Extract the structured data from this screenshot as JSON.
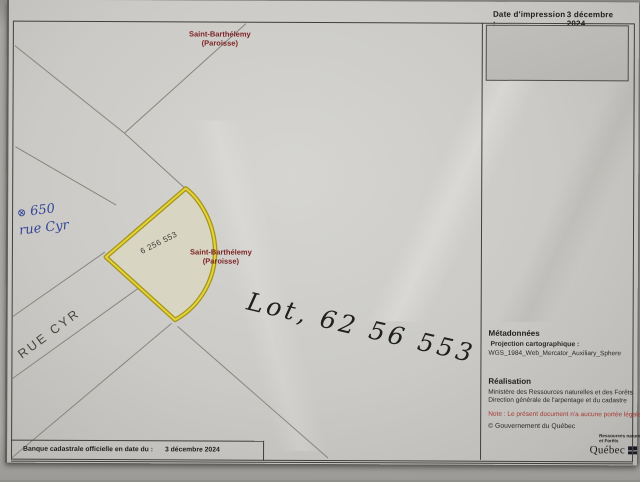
{
  "document": {
    "header": {
      "date_label": "Date d'impression :",
      "date_value": "3 décembre 2024"
    },
    "map": {
      "municipality_top": {
        "line1": "Saint-Barthélemy",
        "line2": "(Paroisse)"
      },
      "municipality_center": {
        "line1": "Saint-Barthélemy",
        "line2": "(Paroisse)"
      },
      "lot_number": "6 256 553",
      "street_label": "RUE CYR",
      "handwritten_blue": {
        "symbol": "⊗",
        "line1": "650",
        "line2": "rue Cyr"
      },
      "handwritten_black": "Lot, 62 56 553"
    },
    "sidebar": {
      "metadata_title": "Métadonnées",
      "projection_label": "Projection cartographique :",
      "projection_value": "WGS_1984_Web_Mercator_Auxiliary_Sphere",
      "realisation_title": "Réalisation",
      "realisation_org": "Ministère des Ressources naturelles et des Forêts",
      "realisation_dept": "Direction générale de l'arpentage et du cadastre",
      "legal_note": "Note : Le présent document n'a aucune portée légale",
      "copyright": "© Gouvernement du Québec",
      "logo": {
        "line1": "Ressources naturelles",
        "line2": "et Forêts",
        "wordmark": "Québec"
      }
    },
    "footer": {
      "label": "Banque cadastrale officielle en date du :",
      "value": "3 décembre 2024"
    }
  },
  "colors": {
    "lot_outline": "#c9b71f",
    "lot_fill": "#d9d5c3",
    "municipality_label": "#7d2426",
    "legal_note_red": "#a63a35",
    "handwritten_blue_ink": "#36479b",
    "handwritten_black_ink": "#20201e",
    "paper": "#c9c8c4"
  }
}
